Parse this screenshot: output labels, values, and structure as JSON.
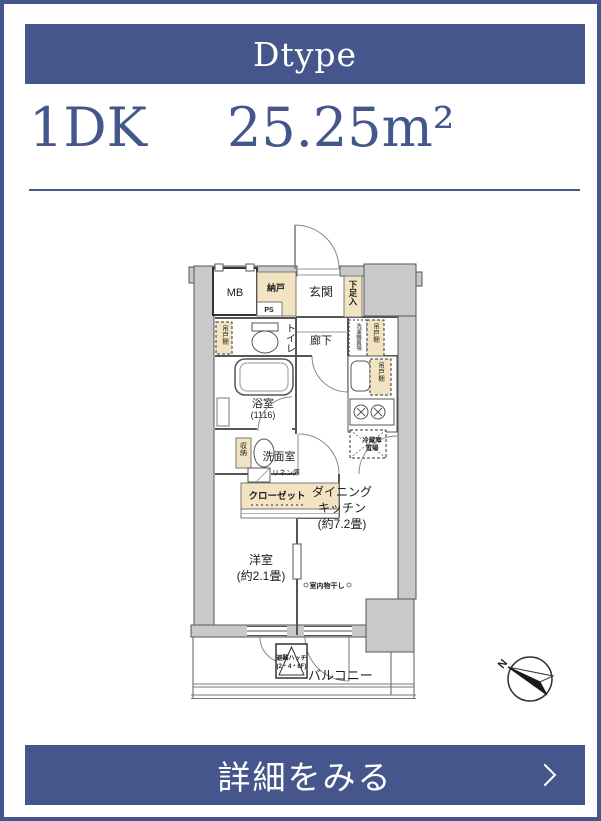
{
  "header": {
    "type_label": "Dtype"
  },
  "summary": {
    "layout": "1DK",
    "area": "25.25m²"
  },
  "plan": {
    "labels": {
      "mb": "MB",
      "nando": "納戸",
      "ps": "PS",
      "genkan": "玄関",
      "shoe_box": "下足入",
      "toilet": "トイレ",
      "corridor": "廊下",
      "cabinet_toilet": "吊戸棚",
      "washer": "洗濯機置場",
      "cabinet_kitchen_upper": "吊戸棚",
      "cabinet_kitchen_lower": "吊戸棚",
      "bath": "浴室",
      "bath_size": "(1116)",
      "washroom": "洗面室",
      "linen": "リネン庫",
      "storage": "収納",
      "closet": "クローゼット",
      "fridge_line1": "冷蔵庫",
      "fridge_line2": "置場",
      "dk_line1": "ダイニング",
      "dk_line2": "キッチン",
      "dk_line3": "(約7.2畳)",
      "bedroom_line1": "洋室",
      "bedroom_line2": "(約2.1畳)",
      "drying": "室内物干し",
      "hatch_line1": "避難ハッチ",
      "hatch_line2": "(2・4・6F)",
      "balcony": "バルコニー",
      "compass_north": "N"
    }
  },
  "footer": {
    "details_label": "詳細をみる"
  },
  "colors": {
    "primary": "#45568c",
    "beige": "#f3e4c1",
    "wall_gray": "#c9c9c9"
  }
}
